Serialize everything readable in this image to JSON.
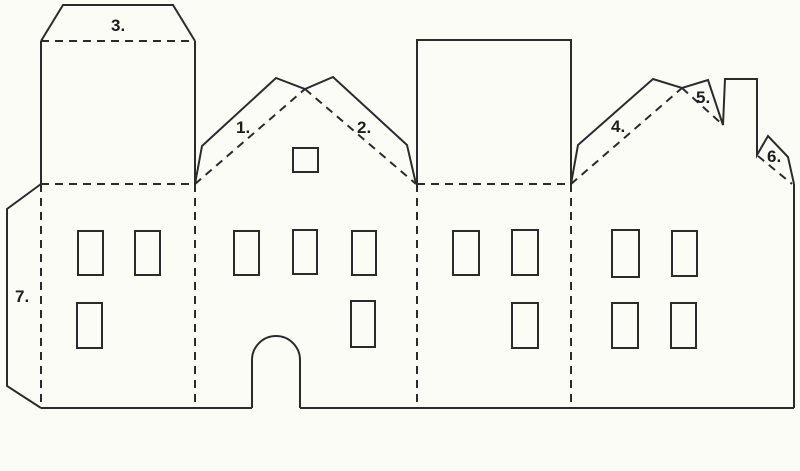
{
  "colors": {
    "background": "#fcfcf7",
    "line": "#2b2b2b",
    "ink": "#1d1d1d"
  },
  "labels": {
    "l1": "1.",
    "l2": "2.",
    "l3": "3.",
    "l4": "4.",
    "l5": "5.",
    "l6": "6.",
    "l7": "7."
  }
}
